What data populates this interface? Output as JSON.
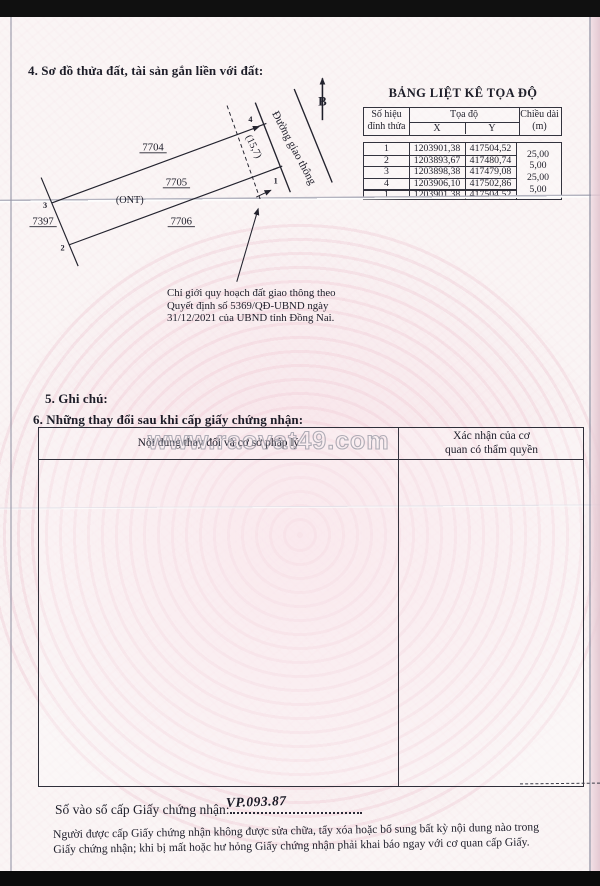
{
  "sections": {
    "s4": "4. Sơ đồ thửa đất, tài sản gắn liền với đất:",
    "s5": "5. Ghi chú:",
    "s6": "6. Những thay đổi sau khi cấp giấy chứng nhận:"
  },
  "diagram": {
    "north_label": "B",
    "road_label": "Đường giao thông",
    "parcel_top": "7704",
    "parcel_mid": "7705",
    "parcel_mid_type": "(ONT)",
    "parcel_bottom": "7706",
    "parcel_left": "7397",
    "frontage_dim": "(15,7)",
    "v1": "1",
    "v2": "2",
    "v3": "3",
    "v4": "4",
    "note_1": "Chỉ giới quy hoạch đất giao thông theo",
    "note_2": "Quyết định số 5369/QĐ-UBND ngày",
    "note_3": "31/12/2021 của UBND tỉnh Đồng Nai."
  },
  "coord_table": {
    "title": "BẢNG LIỆT KÊ TỌA ĐỘ",
    "h_vertex_1": "Số hiệu",
    "h_vertex_2": "đỉnh thửa",
    "h_coords": "Tọa độ",
    "h_x": "X",
    "h_y": "Y",
    "h_len_1": "Chiều dài",
    "h_len_2": "(m)",
    "rows": [
      {
        "id": "1",
        "x": "1203901,38",
        "y": "417504,52"
      },
      {
        "id": "2",
        "x": "1203893,67",
        "y": "417480,74"
      },
      {
        "id": "3",
        "x": "1203898,38",
        "y": "417479,08"
      },
      {
        "id": "4",
        "x": "1203906,10",
        "y": "417502,86"
      },
      {
        "id": "1",
        "x": "1203901,38",
        "y": "417504,52"
      }
    ],
    "lengths": [
      "25,00",
      "5,00",
      "25,00",
      "5,00"
    ]
  },
  "changes_table": {
    "col_content": "Nội dung thay đổi và cơ sở pháp lý",
    "col_confirm_1": "Xác nhận của cơ",
    "col_confirm_2": "quan có thẩm quyền"
  },
  "watermark": "www.raovat49.com",
  "footer": {
    "serial_label": "Số vào sổ cấp Giấy chứng nhận:",
    "serial_value": "VP.093.87",
    "notice_1": "Người được cấp Giấy chứng nhận không được sửa chữa, tẩy xóa hoặc bổ sung bất kỳ nội dung nào trong",
    "notice_2": "Giấy chứng nhận; khi bị mất hoặc hư hỏng Giấy chứng nhận phải khai báo ngay với cơ quan cấp Giấy."
  }
}
